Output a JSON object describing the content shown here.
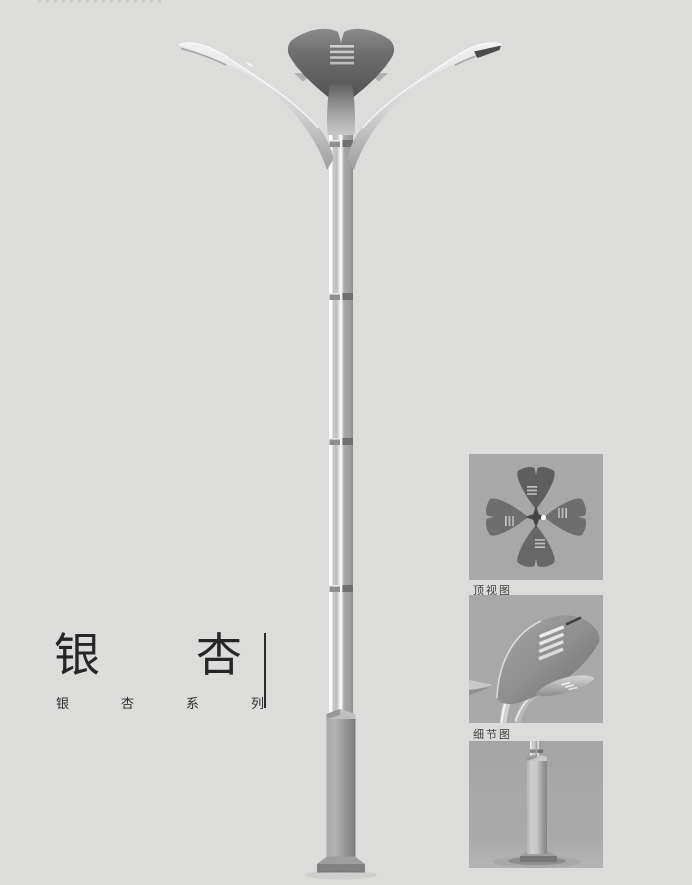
{
  "page": {
    "background_color": "#dcdcdb"
  },
  "title_block": {
    "title": "银杏",
    "subtitle": "银杏系列"
  },
  "figure": {
    "name": "ginkgo-double-arm-street-lamp-render"
  },
  "detail_panels": [
    {
      "name": "lamp-top-view-image",
      "label": "顶视图"
    },
    {
      "name": "lamp-crown-detail-image",
      "label": "细节图"
    },
    {
      "name": "lamp-base-image",
      "label": ""
    }
  ],
  "colors": {
    "panel_background": "#a8a8a8",
    "crown_dark_metal": "#6d6d6d",
    "pole_silver": "#c9c9c9",
    "title_text": "#262626",
    "caption_text": "#3e3e3e"
  }
}
